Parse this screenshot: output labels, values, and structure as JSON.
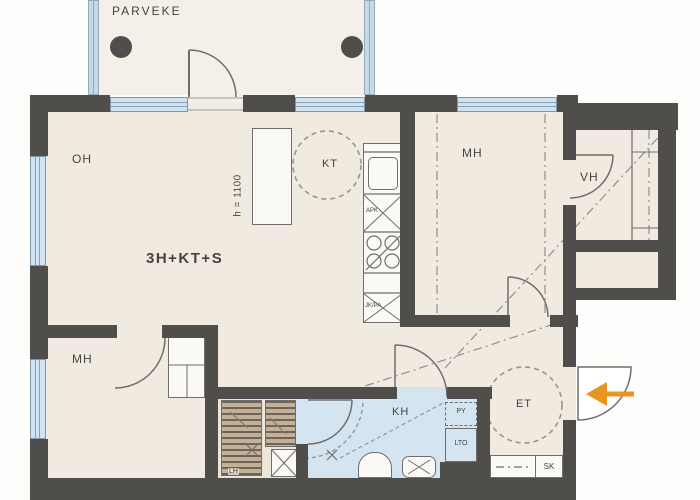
{
  "plan": {
    "balcony_label": "PARVEKE",
    "apartment_type": "3H+KT+S",
    "labels": {
      "living": "OH",
      "kitchen": "KT",
      "bedroom_top": "MH",
      "closet": "VH",
      "bedroom_bottom": "MH",
      "bathroom": "KH",
      "entry": "ET",
      "sauna_bench": "LH"
    },
    "fixtures": {
      "washer": "PY",
      "heat_recovery": "LTO",
      "cleaning_closet": "SK",
      "dishwasher": "APK",
      "fridge_freezer": "JK/PA"
    },
    "annotations": {
      "counter_height": "h = 1100"
    },
    "colors": {
      "wall": "#4f4e4a",
      "floor": "#f0eae1",
      "wet_floor": "#d4e4f1",
      "window": "#cfe3f2",
      "accent_arrow": "#e8941f"
    }
  }
}
